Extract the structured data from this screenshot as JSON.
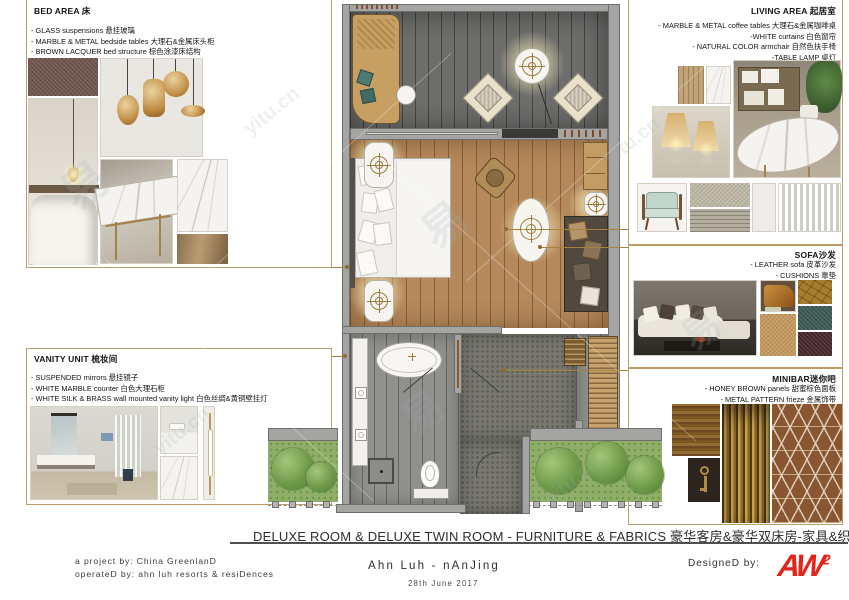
{
  "sections": {
    "bed_area": {
      "title": "BED AREA 床",
      "bullets": [
        "- GLASS suspensions 悬挂玻璃",
        "- MARBLE & METAL bedside tables 大理石&金属床头柜",
        "- BROWN LACQUER bed structure 棕色涂漆床结构"
      ]
    },
    "living_area": {
      "title": "LIVING AREA 起居室",
      "bullets": [
        "- MARBLE & METAL coffee tables 大理石&金属咖啡桌",
        "-WHITE curtains 白色窗帘",
        "- NATURAL COLOR armchair 自然色扶手椅",
        "-TABLE LAMP 桌灯"
      ]
    },
    "sofa": {
      "title": "SOFA沙发",
      "bullets": [
        "- LEATHER sofa 皮革沙发",
        "- CUSHIONS 靠垫"
      ]
    },
    "minibar": {
      "title": "MINIBAR迷你吧",
      "bullets": [
        "- HONEY BROWN panels 甜蜜棕色面板",
        "- METAL PATTERN frieze 金属饰带"
      ]
    },
    "vanity": {
      "title": "VANITY UNIT 梳妆间",
      "bullets": [
        "- SUSPENDED mirrors 悬挂镜子",
        "- WHITE MARBLE counter 白色大理石柜",
        "- WHITE SILK & BRASS wall mounted vanity light 白色丝绸&黄铜壁挂灯"
      ]
    }
  },
  "title_bar": {
    "title": "DELUXE ROOM & DELUXE TWIN ROOM - FURNITURE & FABRICS 豪华客房&豪华双床房-家具&织物"
  },
  "footer": {
    "project_by": "a project by: China GreenlanD",
    "operated_by": "operateD by: ahn luh resorts & resiDences",
    "hotel_name": "Ahn Luh - nAnJing",
    "date": "28th June 2017",
    "designed_by_label": "DesigneD by:",
    "logo_text": "AW",
    "logo_sup": "2"
  },
  "watermark": {
    "site": "yitu.cn",
    "glyph": "易"
  },
  "colors": {
    "accent_gold": "#bb9d69",
    "leader_line": "#a2833f",
    "logo_red": "#e32419",
    "wall_gray": "#a4a4a2",
    "wood_floor": "#b5895c",
    "deck_gray": "#6d6d6b"
  }
}
